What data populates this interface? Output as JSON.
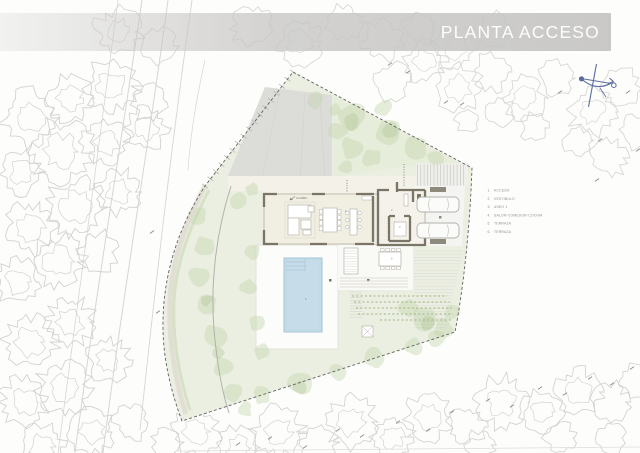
{
  "title": {
    "label": "PLANTA ACCESO"
  },
  "legend": {
    "items": [
      {
        "num": "1",
        "label": "ACCESO"
      },
      {
        "num": "2",
        "label": "VESTIBULO"
      },
      {
        "num": "3",
        "label": "ASEO 1"
      },
      {
        "num": "4",
        "label": "SALON-COMEDOR-COCINA"
      },
      {
        "num": "5",
        "label": "TERRAZA"
      },
      {
        "num": "6",
        "label": "TERRAZA"
      }
    ]
  },
  "plan": {
    "entry_label": "ACCESO"
  },
  "icons": {
    "compass": "north-compass-icon"
  },
  "colors": {
    "banner_gray": "#c5c4c2",
    "title_text": "#ffffff",
    "wall": "#7b7568",
    "wall_light": "#c9c6bd",
    "floor_cream": "#f1eee2",
    "walkway_cream": "#f3f1e8",
    "pool_water": "#c6dde9",
    "pool_edge": "#a4c5d6",
    "lawn": "#ebefe2",
    "ne_green": "#e6ecd9",
    "vegetation_green": "#c2d4ab",
    "vegetation_dark": "#abc28f",
    "hedge_green": "#a9bd90",
    "driveway_gray": "#dcdcd9",
    "deck_white": "#fcfcfa",
    "terrace_white": "#f9f9f6",
    "parking_gray": "#f4f4f2",
    "paver_dark": "#8f8a7e",
    "tree_outline": "#d3d2ce",
    "tree_outline_top": "#d9d8d4",
    "boundary_line": "#62625f",
    "road_line": "#d7d6d2",
    "furniture_line": "#bcb9b0",
    "compass_blue": "#5a6d9c",
    "legend_text": "#8f8f8b",
    "mark_gray": "#8d8d89"
  }
}
